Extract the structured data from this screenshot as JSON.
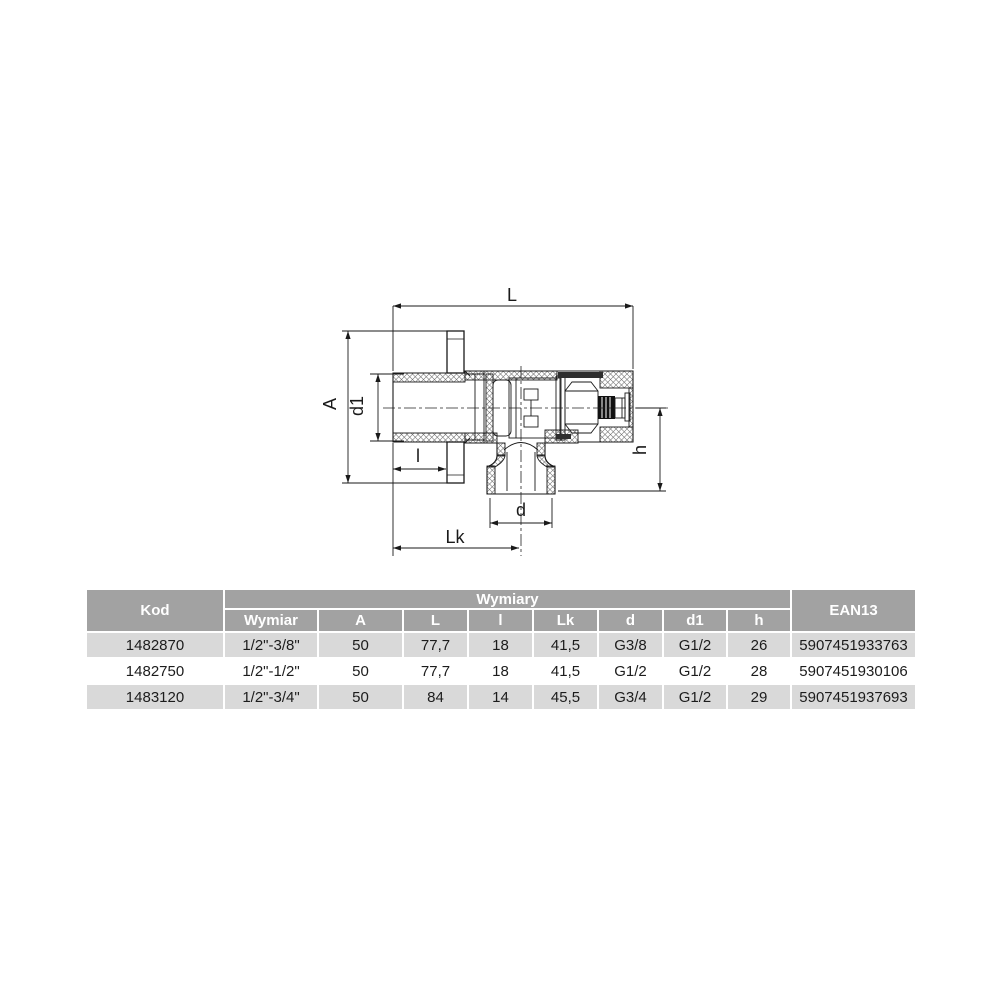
{
  "colors": {
    "header_bg": "#a2a2a2",
    "header_text": "#ffffff",
    "row_alt_bg": "#d9d9d9",
    "row_bg": "#ffffff",
    "line": "#1a1a1a",
    "table_text": "#1c1c1c"
  },
  "drawing": {
    "description": "angle-valve-cross-section",
    "dim_labels": {
      "L": "L",
      "A": "A",
      "d1": "d1",
      "l": "l",
      "Lk": "Lk",
      "d": "d",
      "h": "h"
    }
  },
  "table": {
    "header": {
      "kod": "Kod",
      "wymiary": "Wymiary",
      "ean13": "EAN13",
      "sub": [
        "Wymiar",
        "A",
        "L",
        "l",
        "Lk",
        "d",
        "d1",
        "h"
      ]
    },
    "rows": [
      [
        "1482870",
        "1/2\"-3/8\"",
        "50",
        "77,7",
        "18",
        "41,5",
        "G3/8",
        "G1/2",
        "26",
        "5907451933763"
      ],
      [
        "1482750",
        "1/2\"-1/2\"",
        "50",
        "77,7",
        "18",
        "41,5",
        "G1/2",
        "G1/2",
        "28",
        "5907451930106"
      ],
      [
        "1483120",
        "1/2\"-3/4\"",
        "50",
        "84",
        "14",
        "45,5",
        "G3/4",
        "G1/2",
        "29",
        "5907451937693"
      ]
    ]
  }
}
